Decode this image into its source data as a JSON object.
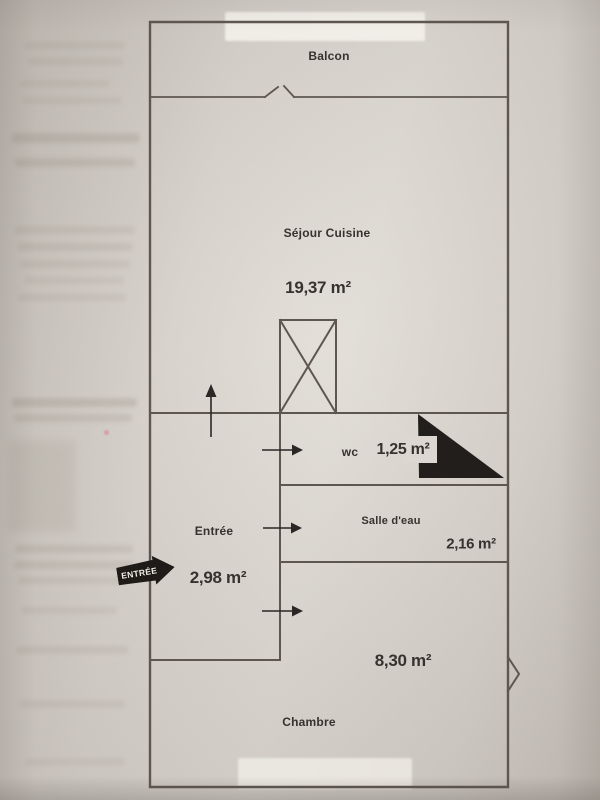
{
  "plan": {
    "balcon": {
      "label": "Balcon"
    },
    "sejour_cuisine": {
      "label": "Séjour Cuisine",
      "area": "19,37 m²"
    },
    "wc": {
      "label": "wc",
      "area": "1,25 m²"
    },
    "salle_eau": {
      "label": "Salle d'eau",
      "area": "2,16 m²"
    },
    "entree": {
      "label": "Entrée",
      "area": "2,98 m²"
    },
    "chambre": {
      "label": "Chambre",
      "area": "8,30 m²"
    },
    "entrance_tag": {
      "label": "ENTRÉE"
    }
  },
  "colors": {
    "paper": "#ded9d2",
    "photo_margin": "#c6c1b9",
    "wall_line": "#5d574f",
    "ink_text": "#37322d",
    "solid_black": "#221e1b"
  }
}
